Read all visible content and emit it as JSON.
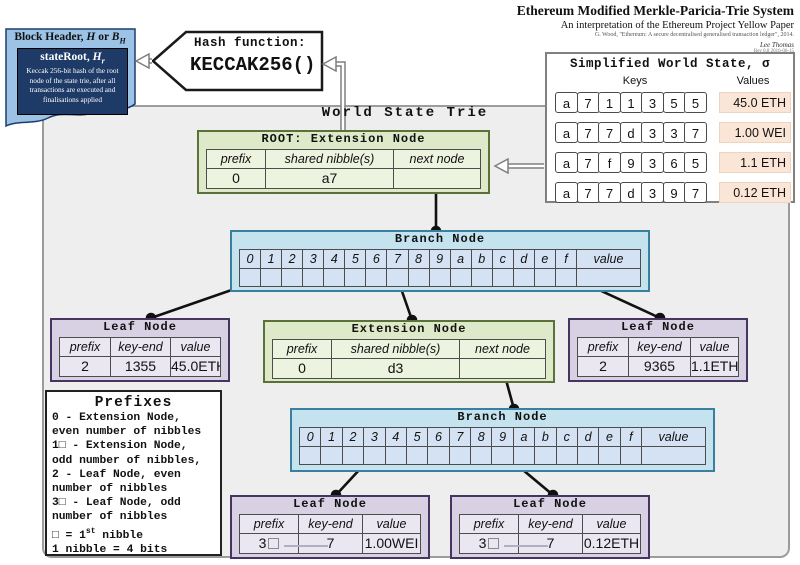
{
  "title_block": {
    "title": "Ethereum Modified Merkle-Paricia-Trie System",
    "subtitle": "An interpretation of the Ethereum Project Yellow Paper",
    "citation": "G. Wood, \"Ethereum: A secure decentralised generalised transaction ledger\", 2014.",
    "author": "Lee Thomas",
    "revision": "Rev 0.8 2016-06-15"
  },
  "block_header": {
    "title_prefix": "Block Header, ",
    "title_h": "H",
    "title_or": " or ",
    "title_b": "B",
    "title_b_sub": "H",
    "stateroot_label": "stateRoot",
    "stateroot_comma": ", ",
    "stateroot_h": "H",
    "stateroot_sub": "r",
    "description": "Keccak 256-bit hash of the root node of the state trie, after all transactions are executed and finalisations applied"
  },
  "hash_banner": {
    "label": "Hash function:",
    "function": "KECCAK256()"
  },
  "trie": {
    "label": "World State Trie"
  },
  "world_state": {
    "title": "Simplified World State, σ",
    "keys_header": "Keys",
    "values_header": "Values",
    "rows": [
      {
        "key": [
          "a",
          "7",
          "1",
          "1",
          "3",
          "5",
          "5"
        ],
        "value": "45.0 ETH"
      },
      {
        "key": [
          "a",
          "7",
          "7",
          "d",
          "3",
          "3",
          "7"
        ],
        "value": "1.00 WEI"
      },
      {
        "key": [
          "a",
          "7",
          "f",
          "9",
          "3",
          "6",
          "5"
        ],
        "value": "1.1 ETH"
      },
      {
        "key": [
          "a",
          "7",
          "7",
          "d",
          "3",
          "9",
          "7"
        ],
        "value": "0.12 ETH"
      }
    ]
  },
  "nodes": {
    "root_extension": {
      "title": "ROOT: Extension Node",
      "headers": [
        "prefix",
        "shared nibble(s)",
        "next node"
      ],
      "values": [
        "0",
        "a7",
        ""
      ]
    },
    "branch_1": {
      "title": "Branch Node",
      "headers": [
        "0",
        "1",
        "2",
        "3",
        "4",
        "5",
        "6",
        "7",
        "8",
        "9",
        "a",
        "b",
        "c",
        "d",
        "e",
        "f",
        "value"
      ]
    },
    "leaf_left": {
      "title": "Leaf Node",
      "headers": [
        "prefix",
        "key-end",
        "value"
      ],
      "values": [
        "2",
        "1355",
        "45.0ETH"
      ]
    },
    "extension_mid": {
      "title": "Extension Node",
      "headers": [
        "prefix",
        "shared nibble(s)",
        "next node"
      ],
      "values": [
        "0",
        "d3",
        ""
      ]
    },
    "leaf_right": {
      "title": "Leaf Node",
      "headers": [
        "prefix",
        "key-end",
        "value"
      ],
      "values": [
        "2",
        "9365",
        "1.1ETH"
      ]
    },
    "branch_2": {
      "title": "Branch Node",
      "headers": [
        "0",
        "1",
        "2",
        "3",
        "4",
        "5",
        "6",
        "7",
        "8",
        "9",
        "a",
        "b",
        "c",
        "d",
        "e",
        "f",
        "value"
      ]
    },
    "leaf_bottom_left": {
      "title": "Leaf Node",
      "headers": [
        "prefix",
        "key-end",
        "value"
      ],
      "values": [
        "3□",
        "7",
        "1.00WEI"
      ]
    },
    "leaf_bottom_right": {
      "title": "Leaf Node",
      "headers": [
        "prefix",
        "key-end",
        "value"
      ],
      "values": [
        "3□",
        "7",
        "0.12ETH"
      ]
    }
  },
  "prefixes_legend": {
    "title": "Prefixes",
    "lines": [
      {
        "t": "0 - Extension Node,"
      },
      {
        "t": "even number of nibbles"
      },
      {
        "t": "1□ - Extension Node,"
      },
      {
        "t": "odd number of nibbles,"
      },
      {
        "t": "2 - Leaf Node, even"
      },
      {
        "t": "number of nibbles"
      },
      {
        "t": "3□ - Leaf Node, odd"
      },
      {
        "t": "number of nibbles"
      },
      {
        "t": "□ = 1",
        "sup": "st",
        "rest": " nibble"
      },
      {
        "t": "1 nibble = 4 bits"
      }
    ]
  },
  "colors": {
    "extension_green": "#dde9c8",
    "extension_border": "#5b7137",
    "extension_cell": "#ecf3de",
    "branch_blue": "#c5e3ef",
    "branch_border": "#39809e",
    "branch_cell": "#d4e2f3",
    "leaf_purple": "#d8d0e3",
    "leaf_border": "#463461",
    "leaf_cell": "#eae6f2",
    "value_peach": "#fbe5d6",
    "header_navy": "#1e3a66",
    "flag_blue": "#9cc3e5",
    "container_gray": "#eeeeee"
  }
}
